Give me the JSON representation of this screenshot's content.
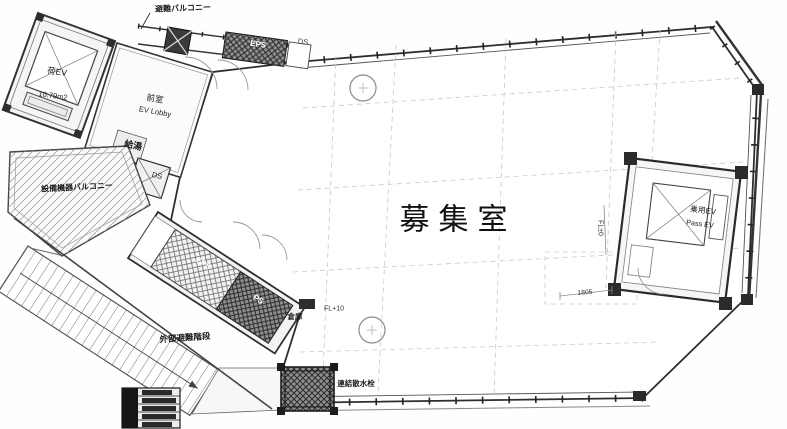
{
  "plan": {
    "labels": {
      "main_room": "募集室",
      "top_balcony": "避難バルコニー",
      "service_ev": "荷EV",
      "service_ev_area": "10.79m2",
      "ev_lobby_jp": "前室",
      "ev_lobby_en": "EV Lobby",
      "kyuto": "給湯",
      "ds_upper": "DS",
      "eps_top": "EPS",
      "ds_top": "DS",
      "equipment_balcony": "設備機器バルコニー",
      "eps_corridor": "EPS",
      "ps_corridor": "PS",
      "external_stairs": "外部避難階段",
      "storage": "倉庫",
      "fl_plus10": "FL+10",
      "fl_zero": "FL±0",
      "dim_1805": "1805",
      "sprinkler": "連結散水栓",
      "passenger_ev_jp": "乗用EV",
      "passenger_ev_en": "Pass EV"
    },
    "colors": {
      "ink": "#222222",
      "paper": "#ffffff",
      "hatch": "#8f8f8f"
    }
  }
}
